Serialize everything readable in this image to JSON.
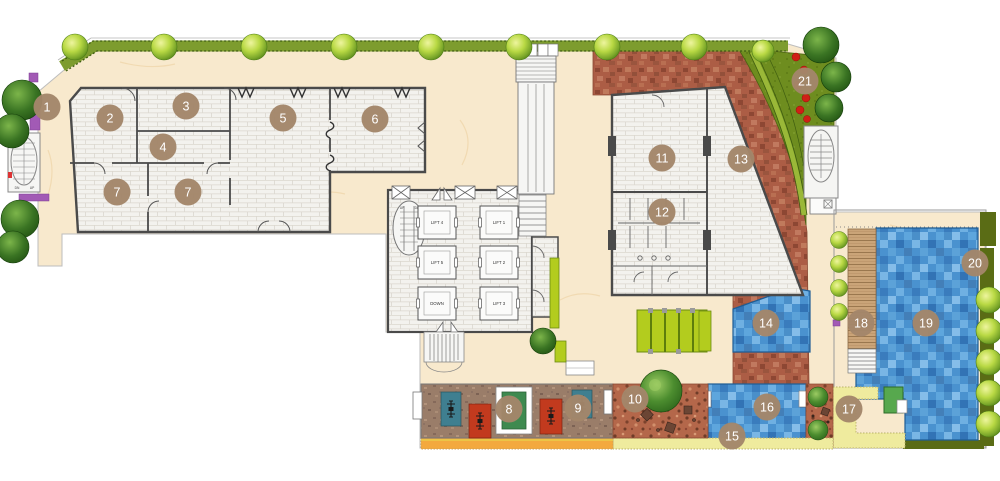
{
  "plan": {
    "markers": [
      {
        "label": "1"
      },
      {
        "label": "2"
      },
      {
        "label": "3"
      },
      {
        "label": "4"
      },
      {
        "label": "5"
      },
      {
        "label": "6"
      },
      {
        "label": "7"
      },
      {
        "label": "7"
      },
      {
        "label": "8"
      },
      {
        "label": "9"
      },
      {
        "label": "10"
      },
      {
        "label": "11"
      },
      {
        "label": "12"
      },
      {
        "label": "13"
      },
      {
        "label": "14"
      },
      {
        "label": "15"
      },
      {
        "label": "16"
      },
      {
        "label": "17"
      },
      {
        "label": "18"
      },
      {
        "label": "19"
      },
      {
        "label": "20"
      },
      {
        "label": "21"
      }
    ],
    "lifts": {
      "lift1": "LIFT 1",
      "lift2": "LIFT 2",
      "lift3": "LIFT 3",
      "lift4": "LIFT 4",
      "lift5": "LIFT 5",
      "service": "DOWN"
    },
    "stair_labels": {
      "up": "UP",
      "down": "DN"
    },
    "palette": {
      "cream": "#f8e9cd",
      "brick": "#f3f2ee",
      "wall": "#4a4a4a",
      "terracotta": "#ac5d45",
      "lawn": "#6e8d1f",
      "hedge": "#7d9c2e",
      "tree_lime": "#b9d944",
      "tree_dark": "#2f6b1b",
      "pool_blue": "#4a92cf",
      "deck_wood": "#caa478",
      "gym_deck": "#9a7d69",
      "walkway_yellow": "#efeb9e",
      "track_orange": "#f3a93e",
      "olive": "#5a6c15",
      "marker": "#a3866a",
      "flower_red": "#cf2015",
      "flower_purple": "#a25ab5",
      "mat_teal": "#3f7f90",
      "mat_red": "#c23a1e",
      "planter_lime": "#b3cc1e",
      "pool_step": "#57a84e"
    }
  }
}
